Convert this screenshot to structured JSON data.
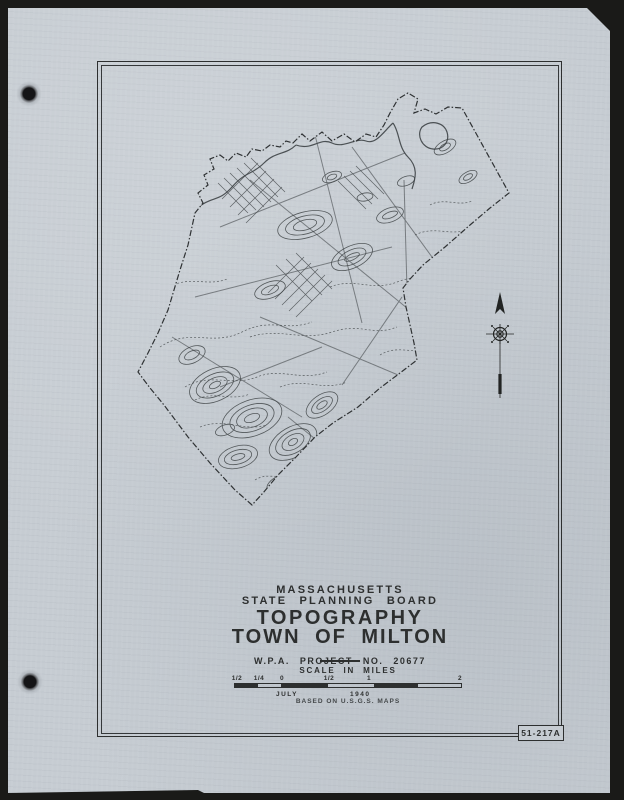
{
  "colors": {
    "background": "#1a1a18",
    "paper": "#c6ccd2",
    "ink": "#2d2f2f",
    "map_ink": "#45494b"
  },
  "titleblock": {
    "region_line": "MASSACHUSETTS",
    "agency_line": "STATE PLANNING BOARD",
    "title_line1": "TOPOGRAPHY",
    "title_line2": "TOWN OF MILTON",
    "project_line": "W.P.A. PROJECT NO. 20677"
  },
  "scalebar": {
    "heading": "SCALE IN MILES",
    "ticks": [
      "1/2",
      "1/4",
      "0",
      "1/2",
      "1",
      "2"
    ],
    "month": "JULY",
    "year": "1940",
    "source_note": "BASED ON U.S.G.S. MAPS"
  },
  "plate_label": "51-217A",
  "map": {
    "subject": "town-of-milton-topography",
    "north_arrow": "north-arrow"
  }
}
